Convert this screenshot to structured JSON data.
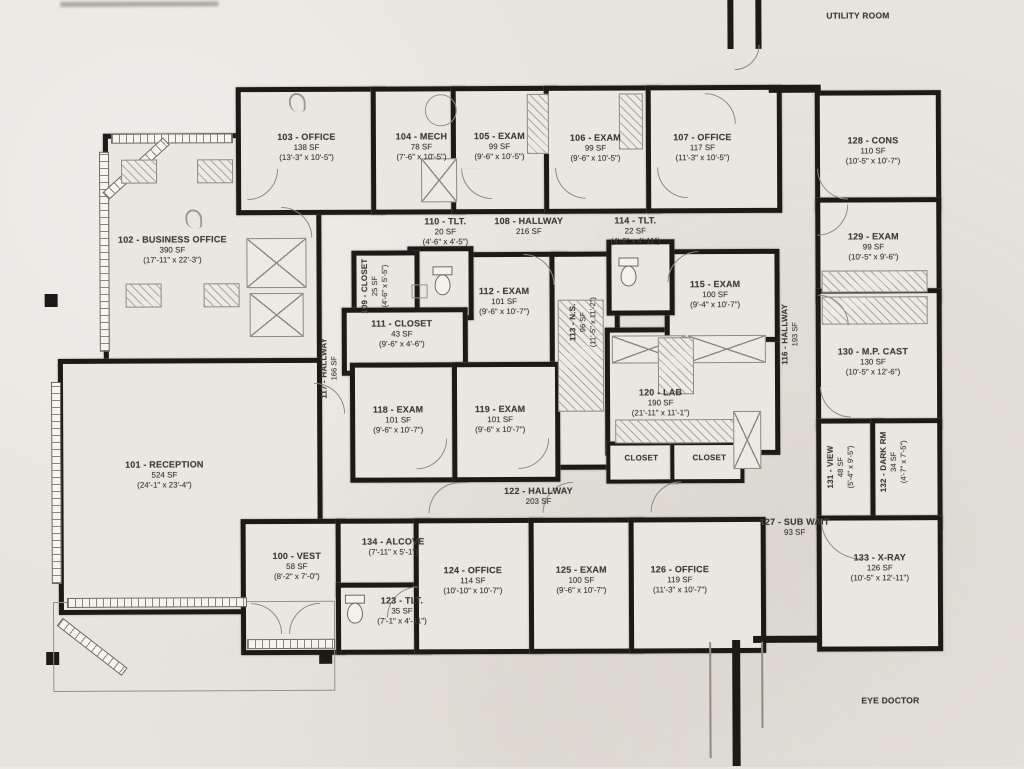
{
  "colors": {
    "paper": "#e7e4de",
    "wall": "#1c1a17",
    "ink": "#413e38"
  },
  "annotations": {
    "utility_room": "UTILITY ROOM",
    "eye_doctor": "EYE DOCTOR"
  },
  "rooms": [
    {
      "name": "103 - OFFICE",
      "sf": "138 SF",
      "dims": "(13'-3\" x 10'-5\")"
    },
    {
      "name": "104 - MECH",
      "sf": "78 SF",
      "dims": "(7'-6\" x 10'-5\")"
    },
    {
      "name": "105 - EXAM",
      "sf": "99 SF",
      "dims": "(9'-6\" x 10'-5\")"
    },
    {
      "name": "106 - EXAM",
      "sf": "99 SF",
      "dims": "(9'-6\" x 10'-5\")"
    },
    {
      "name": "107 - OFFICE",
      "sf": "117 SF",
      "dims": "(11'-3\" x 10'-5\")"
    },
    {
      "name": "128 - CONS",
      "sf": "110 SF",
      "dims": "(10'-5\" x 10'-7\")"
    },
    {
      "name": "129 - EXAM",
      "sf": "99 SF",
      "dims": "(10'-5\" x 9'-6\")"
    },
    {
      "name": "102 - BUSINESS OFFICE",
      "sf": "390 SF",
      "dims": "(17'-11\" x 22'-3\")"
    },
    {
      "name": "110 - TLT.",
      "sf": "20 SF",
      "dims": "(4'-6\" x 4'-5\")"
    },
    {
      "name": "108 - HALLWAY",
      "sf": "216 SF"
    },
    {
      "name": "114 - TLT.",
      "sf": "22 SF",
      "dims": "(4'-6\" x 4'-11\")"
    },
    {
      "name": "109 - CLOSET",
      "sf": "25 SF",
      "dims": "(4'-6\" x 5'-5\")"
    },
    {
      "name": "111 - CLOSET",
      "sf": "43 SF",
      "dims": "(9'-6\" x 4'-6\")"
    },
    {
      "name": "112 - EXAM",
      "sf": "101 SF",
      "dims": "(9'-6\" x 10'-7\")"
    },
    {
      "name": "113 - N.S.",
      "sf": "96 SF",
      "dims": "(11'-5\" x 11'-2\")"
    },
    {
      "name": "115 - EXAM",
      "sf": "100 SF",
      "dims": "(9'-4\" x 10'-7\")"
    },
    {
      "name": "116 - HALLWAY",
      "sf": "193 SF"
    },
    {
      "name": "130 - M.P. CAST",
      "sf": "130 SF",
      "dims": "(10'-5\" x 12'-6\")"
    },
    {
      "name": "117 - HALLWAY",
      "sf": "166 SF"
    },
    {
      "name": "118 - EXAM",
      "sf": "101 SF",
      "dims": "(9'-6\" x 10'-7\")"
    },
    {
      "name": "119 - EXAM",
      "sf": "101 SF",
      "dims": "(9'-6\" x 10'-7\")"
    },
    {
      "name": "120 - LAB",
      "sf": "190 SF",
      "dims": "(21'-11\" x 11'-1\")"
    },
    {
      "name": "101 - RECEPTION",
      "sf": "524 SF",
      "dims": "(24'-1\" x 23'-4\")"
    },
    {
      "name": "CLOSET"
    },
    {
      "name": "CLOSET"
    },
    {
      "name": "131 - VIEW",
      "sf": "48 SF",
      "dims": "(5'-4\" x 9'-5\")"
    },
    {
      "name": "132 - DARK RM",
      "sf": "34 SF",
      "dims": "(4'-7\" x 7'-5\")"
    },
    {
      "name": "122 - HALLWAY",
      "sf": "203 SF"
    },
    {
      "name": "127 - SUB WAIT",
      "sf": "93 SF"
    },
    {
      "name": "100 - VEST",
      "sf": "58 SF",
      "dims": "(8'-2\" x 7'-0\")"
    },
    {
      "name": "134 - ALCOVE",
      "dims": "(7'-11\" x 5'-1\")"
    },
    {
      "name": "123 - TLT.",
      "sf": "35 SF",
      "dims": "(7'-1\" x 4'-11\")"
    },
    {
      "name": "124 - OFFICE",
      "sf": "114 SF",
      "dims": "(10'-10\" x 10'-7\")"
    },
    {
      "name": "125 - EXAM",
      "sf": "100 SF",
      "dims": "(9'-6\" x 10'-7\")"
    },
    {
      "name": "126 - OFFICE",
      "sf": "119 SF",
      "dims": "(11'-3\" x 10'-7\")"
    },
    {
      "name": "133 - X-RAY",
      "sf": "126 SF",
      "dims": "(10'-5\" x 12'-11\")"
    }
  ]
}
